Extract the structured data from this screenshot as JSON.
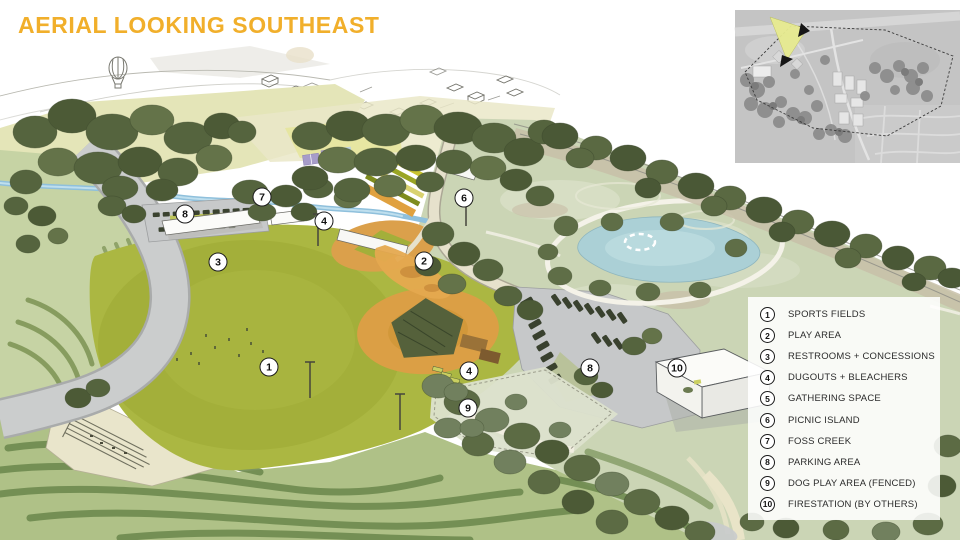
{
  "title": "AERIAL LOOKING SOUTHEAST",
  "colors": {
    "title_accent": "#F1AF2B",
    "legend_background": "rgba(255,255,255,0.88)",
    "marker_fill": "#FFFFFF",
    "marker_border": "#1C1C1C",
    "view_cone": "#E7EB90",
    "sports_field_green": "#ABB742",
    "pond_blue": "#ABD0D6",
    "infield_orange": "#DB9F45"
  },
  "legend": {
    "items": [
      {
        "num": "1",
        "label": "SPORTS FIELDS"
      },
      {
        "num": "2",
        "label": "PLAY AREA"
      },
      {
        "num": "3",
        "label": "RESTROOMS + CONCESSIONS"
      },
      {
        "num": "4",
        "label": "DUGOUTS + BLEACHERS"
      },
      {
        "num": "5",
        "label": "GATHERING SPACE"
      },
      {
        "num": "6",
        "label": "PICNIC ISLAND"
      },
      {
        "num": "7",
        "label": "FOSS CREEK"
      },
      {
        "num": "8",
        "label": "PARKING AREA"
      },
      {
        "num": "9",
        "label": "DOG PLAY AREA (FENCED)"
      },
      {
        "num": "10",
        "label": "FIRESTATION (BY OTHERS)"
      }
    ]
  },
  "map_markers": [
    {
      "num": "8",
      "x": 185,
      "y": 214
    },
    {
      "num": "7",
      "x": 262,
      "y": 197
    },
    {
      "num": "4",
      "x": 324,
      "y": 221
    },
    {
      "num": "6",
      "x": 464,
      "y": 198
    },
    {
      "num": "3",
      "x": 218,
      "y": 262
    },
    {
      "num": "2",
      "x": 424,
      "y": 261
    },
    {
      "num": "1",
      "x": 269,
      "y": 367
    },
    {
      "num": "4",
      "x": 469,
      "y": 371
    },
    {
      "num": "9",
      "x": 468,
      "y": 408
    },
    {
      "num": "8",
      "x": 590,
      "y": 368
    },
    {
      "num": "10",
      "x": 677,
      "y": 368
    }
  ]
}
